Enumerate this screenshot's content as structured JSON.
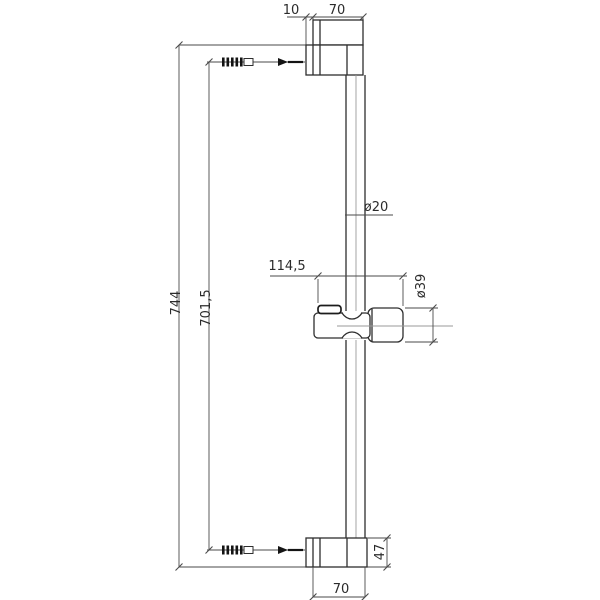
{
  "drawing": {
    "type": "dimensioned technical drawing, shower slide rail side view",
    "labels": {
      "top_offset": "10",
      "top_bracket_width": "70",
      "overall_length": "744",
      "hole_spacing": "701,5",
      "holder_depth": "114,5",
      "rail_diameter": "ø20",
      "holder_diameter": "ø39",
      "bottom_bracket_height": "47",
      "bottom_bracket_width": "70"
    }
  },
  "colors": {
    "background": "#ffffff",
    "object_line": "#2e2e2e",
    "dimension_line": "#4a4a4a"
  }
}
